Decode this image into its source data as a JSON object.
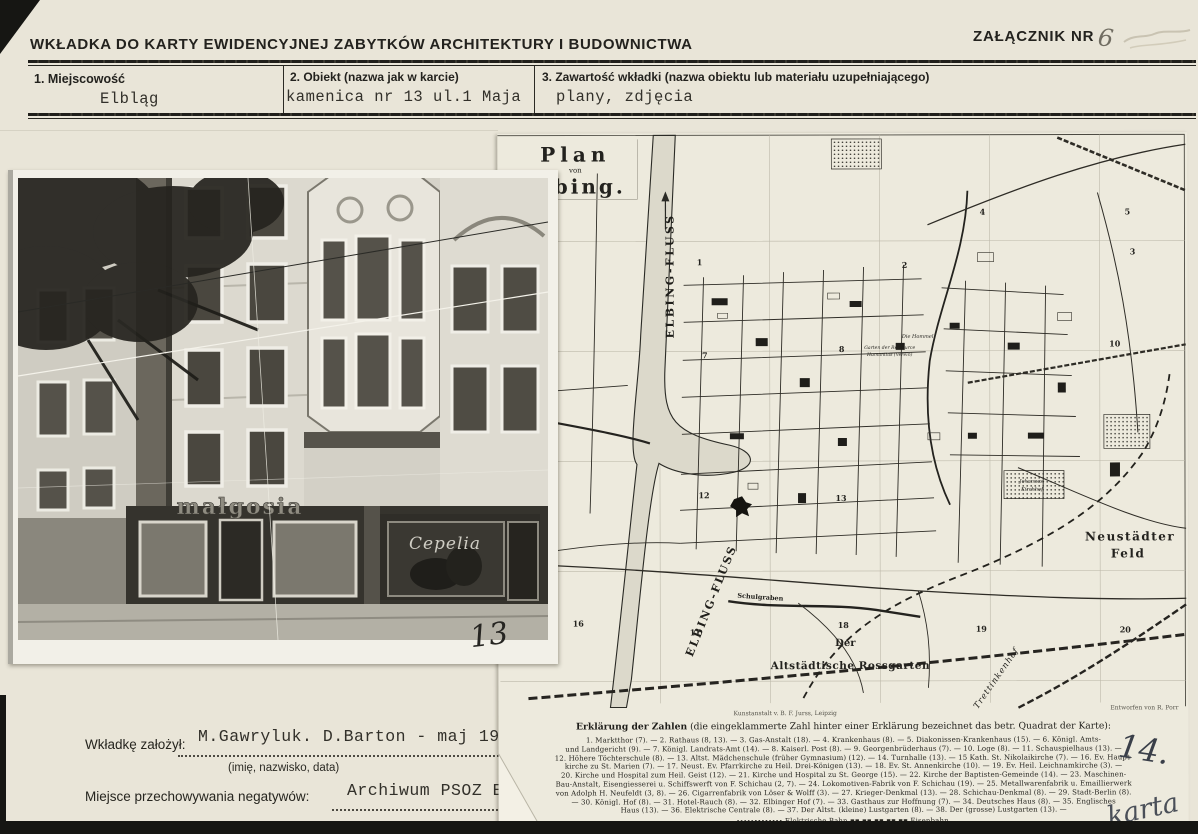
{
  "card": {
    "title": "WKŁADKA  DO  KARTY  EWIDENCYJNEJ  ZABYTKÓW  ARCHITEKTURY  I  BUDOWNICTWA",
    "attachment_label": "ZAŁĄCZNIK NR",
    "attachment_number": "6",
    "fields": [
      {
        "label": "1.  Miejscowość",
        "value": "Elbląg"
      },
      {
        "label": "2.  Obiekt (nazwa jak w karcie)",
        "value": "kamenica nr 13 ul.1 Maja"
      },
      {
        "label": "3.  Zawartość wkładki (nazwa obiektu lub materiału uzupełniającego)",
        "value": "plany, zdjęcia"
      }
    ],
    "footer": {
      "founder_label": "Wkładkę założył:",
      "founder_value": "M.Gawryluk. D.Barton - maj 1993",
      "founder_hint": "(imię, nazwisko, data)",
      "negatives_label": "Miejsce przechowywania negatywów:",
      "negatives_value": "Archiwum PSOZ Elbląg"
    }
  },
  "photo": {
    "shop_sign_left": "małgosia",
    "shop_sign_right": "Cepelia",
    "handwritten_number": "13"
  },
  "map": {
    "title_line1": "Plan",
    "title_line2": "von",
    "title_line3": "Elbing.",
    "river_label_upper": "ELBING-FLUSS",
    "river_label_lower": "ELBING-FLUSS",
    "labels": {
      "neustaedter_1": "Neustädter",
      "neustaedter_2": "Feld",
      "rossgarten_1": "Der",
      "rossgarten_2": "Altstädtische Rossgarten",
      "trettinkenhof": "Trettinkenhof",
      "schulgraben": "Schulgraben",
      "johannes_1": "Johannes-",
      "johannes_2": "Kirchhof",
      "hommel": "Die Hommel",
      "ressource_1": "Garten der Ressource",
      "ressource_2": "Humanitas (Verein)"
    },
    "numbers": [
      "1",
      "2",
      "3",
      "4",
      "5",
      "7",
      "8",
      "10",
      "12",
      "13",
      "16",
      "17",
      "18",
      "19",
      "20"
    ],
    "credit_left": "Kunstanstalt v. B. F. Jurss, Leipzig",
    "credit_right": "Entworfen von R. Porr",
    "legend": {
      "heading_bold": "Erklärung der Zahlen",
      "heading_rest": " (die eingeklammerte Zahl hinter einer Erklärung bezeichnet das betr. Quadrat der Karte):",
      "lines": [
        "1. Marktthor (7). — 2. Rathaus (8, 13). — 3. Gas-Anstalt (18). — 4. Krankenhaus (8). — 5. Diakonissen-Krankenhaus (15). — 6. Königl. Amts-",
        "und Landgericht (9). — 7. Königl. Landrats-Amt (14). — 8. Kaiserl. Post (8). — 9. Georgenbrüderhaus (7). — 10. Loge (8). — 11. Schauspielhaus (13). —",
        "12. Höhere Töchterschule (8). — 13. Altst. Mädchenschule (früher Gymnasium) (12). — 14. Turnhalle (13). — 15 Kath. St. Nikolaikirche (7). — 16. Ev. Haupt-",
        "kirche zu St. Marien (7). — 17. Neust. Ev. Pfarrkirche zu Heil. Drei-Königen (13). — 18. Ev. St. Annenkirche (10). — 19. Ev. Heil. Leichnamkirche (3). —",
        "20. Kirche und Hospital zum Heil. Geist (12). — 21. Kirche und Hospital zu St. George (15). — 22. Kirche der Baptisten-Gemeinde (14). — 23. Maschinen-",
        "Bau-Anstalt, Eisengiesserei u. Schiffswerft von F. Schichau (2, 7). — 24. Lokomotiven-Fabrik von F. Schichau (19). — 25. Metallwarenfabrik u. Emaillierwerk",
        "von Adolph H. Neufeldt (3, 8). — 26. Cigarrenfabrik von Löser & Wolff (3). — 27. Krieger-Denkmal (13). — 28. Schichau-Denkmal (8). — 29. Stadt-Berlin (8).",
        "— 30. Königl. Hof (8). — 31. Hotel-Rauch (8). — 32. Elbinger Hof (7). — 33. Gasthaus zur Hoffnung (7). — 34. Deutsches Haus (8). — 35. Englisches",
        "Haus (13). — 36. Elektrische Centrale (8). — 37. Der Altst. (kleine) Lustgarten (8). — 38. Der (grosse) Lustgarten (13). —"
      ],
      "symbols_line": "∙∙∙∙∙∙∙∙∙∙∙∙∙  Elektrische Bahn        ▪▪ ▪▪ ▪▪ ▪▪ ▪▪  Eisenbahn."
    },
    "handwritten_number": "14.",
    "handwritten_corner": "karta"
  }
}
